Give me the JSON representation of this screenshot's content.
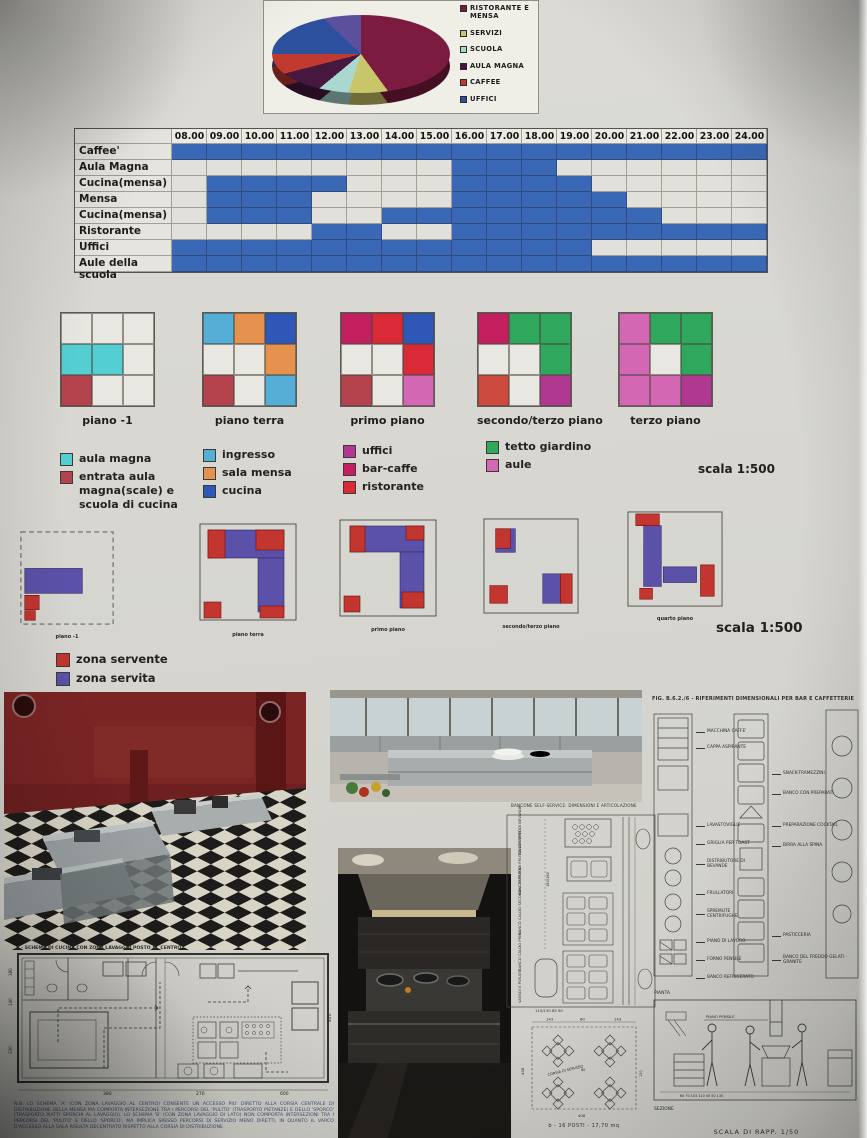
{
  "pie_panel": {
    "legend": [
      {
        "label": "RISTORANTE E MENSA",
        "color": "#7c1b40"
      },
      {
        "label": "SERVIZI",
        "color": "#c9c56a"
      },
      {
        "label": "SCUOLA",
        "color": "#a8d8cf"
      },
      {
        "label": "AULA MAGNA",
        "color": "#46173f"
      },
      {
        "label": "CAFFEE",
        "color": "#c03a30"
      },
      {
        "label": "UFFICI",
        "color": "#2c4f9e"
      }
    ],
    "slices": [
      {
        "label": "RISTORANTE E MENSA",
        "value": 40,
        "color": "#7c1b40"
      },
      {
        "label": "SERVIZI",
        "value": 15,
        "color": "#c9c56a"
      },
      {
        "label": "SCUOLA",
        "value": 9,
        "color": "#a8d8cf"
      },
      {
        "label": "AULA MAGNA",
        "value": 7,
        "color": "#46173f"
      },
      {
        "label": "CAFFEE",
        "value": 4,
        "color": "#c03a30"
      },
      {
        "label": "UFFICI",
        "value": 12,
        "color": "#2c4f9e"
      },
      {
        "label": null,
        "value": 13,
        "color": "#5b4f9e"
      }
    ]
  },
  "schedule": {
    "hours": [
      "08.00",
      "09.00",
      "10.00",
      "11.00",
      "12.00",
      "13.00",
      "14.00",
      "15.00",
      "16.00",
      "17.00",
      "18.00",
      "19.00",
      "20.00",
      "21.00",
      "22.00",
      "23.00",
      "24.00"
    ],
    "bar_color": "#3a68b4",
    "rows": [
      {
        "label": "Caffee'",
        "bars": [
          [
            8,
            25
          ]
        ]
      },
      {
        "label": "Aula Magna",
        "bars": [
          [
            16,
            19
          ]
        ]
      },
      {
        "label": "Cucina(mensa)",
        "bars": [
          [
            9,
            13
          ],
          [
            16,
            20
          ]
        ]
      },
      {
        "label": "Mensa",
        "bars": [
          [
            9,
            12
          ],
          [
            16,
            21
          ]
        ]
      },
      {
        "label": "Cucina(mensa)",
        "bars": [
          [
            9,
            12
          ],
          [
            14,
            22
          ]
        ]
      },
      {
        "label": "Ristorante",
        "bars": [
          [
            12,
            14
          ],
          [
            16,
            25
          ]
        ]
      },
      {
        "label": "Uffici",
        "bars": [
          [
            8,
            20
          ]
        ]
      },
      {
        "label": "Aule della scuola",
        "bars": [
          [
            8,
            25
          ]
        ]
      }
    ]
  },
  "floor_grids": {
    "grids": [
      {
        "label": "piano -1",
        "cells": [
          "",
          "",
          "",
          "#53cfd2",
          "#53cfd2",
          "",
          "#b5434e",
          "",
          ""
        ]
      },
      {
        "label": "piano terra",
        "cells": [
          "#54aed6",
          "#e5924f",
          "#2e57b8",
          "",
          "",
          "#e5924f",
          "#b5434e",
          "",
          "#54aed6"
        ]
      },
      {
        "label": "primo piano",
        "cells": [
          "#c41f5e",
          "#da2a38",
          "#2e57b8",
          "",
          "",
          "#da2a38",
          "#b5434e",
          "",
          "#d467b4"
        ]
      },
      {
        "label": "secondo/terzo piano",
        "cells": [
          "#c41f5e",
          "#2fa85e",
          "#2fa85e",
          "",
          "",
          "#2fa85e",
          "#cd4a3e",
          "",
          "#b03890"
        ]
      },
      {
        "label": "terzo piano",
        "cells": [
          "#d467b4",
          "#2fa85e",
          "#2fa85e",
          "#d467b4",
          "",
          "#2fa85e",
          "#d467b4",
          "#d467b4",
          "#b03890"
        ]
      }
    ]
  },
  "scale_small": "scala  1:500",
  "scale_large": "scala  1:500",
  "legend_groups": [
    {
      "items": [
        {
          "label": "aula magna",
          "color": "#53cfd2"
        },
        {
          "label": "entrata aula magna(scale) e scuola di cucina",
          "color": "#b5434e"
        }
      ]
    },
    {
      "items": [
        {
          "label": "ingresso",
          "color": "#54aed6"
        },
        {
          "label": "sala mensa",
          "color": "#e5924f"
        },
        {
          "label": "cucina",
          "color": "#2e57b8"
        }
      ]
    },
    {
      "items": [
        {
          "label": "uffici",
          "color": "#b03890"
        },
        {
          "label": "bar-caffe",
          "color": "#c41f5e"
        },
        {
          "label": "ristorante",
          "color": "#da2a38"
        }
      ]
    },
    {
      "items": [
        {
          "label": "tetto giardino",
          "color": "#2fa85e"
        },
        {
          "label": "aule",
          "color": "#d467b4"
        }
      ]
    }
  ],
  "plans": {
    "servente_color": "#c3352f",
    "servita_color": "#5b51a8",
    "items": [
      {
        "label": "piano -1",
        "outline": "dashed",
        "servita": [
          [
            6,
            40,
            60,
            26
          ]
        ],
        "servente": [
          [
            6,
            68,
            15,
            15
          ],
          [
            6,
            84,
            11,
            10
          ]
        ]
      },
      {
        "label": "piano terra",
        "outline": "solid",
        "servita": [
          [
            10,
            8,
            76,
            28
          ],
          [
            60,
            36,
            26,
            54
          ]
        ],
        "servente": [
          [
            10,
            8,
            17,
            28
          ],
          [
            58,
            8,
            28,
            20
          ],
          [
            6,
            80,
            17,
            16
          ],
          [
            62,
            84,
            24,
            12
          ]
        ]
      },
      {
        "label": "primo piano",
        "outline": "solid",
        "servita": [
          [
            12,
            8,
            74,
            26
          ],
          [
            62,
            34,
            24,
            56
          ]
        ],
        "servente": [
          [
            12,
            8,
            15,
            26
          ],
          [
            68,
            8,
            18,
            14
          ],
          [
            64,
            74,
            22,
            16
          ],
          [
            6,
            78,
            16,
            16
          ]
        ]
      },
      {
        "label": "secondo/terzo piano",
        "outline": "solid",
        "servita": [
          [
            14,
            12,
            20,
            24
          ],
          [
            62,
            58,
            18,
            30
          ]
        ],
        "servente": [
          [
            14,
            12,
            15,
            20
          ],
          [
            80,
            58,
            12,
            30
          ],
          [
            8,
            70,
            18,
            18
          ]
        ]
      },
      {
        "label": "quarto piano",
        "outline": "solid",
        "servita": [
          [
            18,
            16,
            18,
            62
          ],
          [
            38,
            58,
            34,
            16
          ]
        ],
        "servente": [
          [
            10,
            4,
            24,
            12
          ],
          [
            76,
            56,
            14,
            32
          ],
          [
            14,
            80,
            13,
            11
          ]
        ]
      }
    ]
  },
  "zone_legend": [
    {
      "label": "zona servente",
      "color": "#c3352f"
    },
    {
      "label": "zona servita",
      "color": "#5b51a8"
    }
  ],
  "tech_left": {
    "title": "A - SCHEMA DI CUCINA CON ZONA LAVAGGIO POSTO AL CENTRO",
    "dims_bottom": [
      "380",
      "270",
      "600"
    ],
    "dim_right": "820",
    "dims_left": [
      "180",
      "140",
      "330"
    ],
    "note": "N.B. LO SCHEMA 'A' (CON ZONA LAVAGGIO AL CENTRO) CONSENTE UN ACCESSO PIU' DIRETTO ALLA CORSIA CENTRALE DI DISTRIBUZIONE DELLA MENSA MA COMPORTA INTERSEZIONE TRA I PERCORSI DEL 'PULITO' (TRASPORTO PIETANZE) E DELLO 'SPORCO' (TRASPORTO PIATTI SPORCHI AL LAVAGGIO). LO SCHEMA 'B' (CON ZONA LAVAGGIO DI LATO) NON COMPORTA INTERSEZIONI TRA I PERCORSI DEL 'PULITO' E DELLO 'SPORCO', MA IMPLICA SPESSO PERCORSI DI SERVIZIO MENO DIRETTI, IN QUANTO IL VARCO D'ACCESSO ALLA SALA RISULTA DECENTRATO RISPETTO ALLA CORSIA DI DISTRIBUZIONE"
  },
  "tech_center": {
    "title": "BANCONE SELF-SERVICE: DIMENSIONI E ARTICOLAZIONE",
    "side_labels": [
      "BANCHI FREDDI BEVANDE",
      "BANCHI FREDDI FRUTTA-DESSERT",
      "BANCO CALDO SECONDI-CONTORNI",
      "BANCO CALDO PRIMI",
      "VASSOI E POSATE"
    ],
    "bottom_dims": "110/130      85      50",
    "height_dims": "150/180",
    "corsia_label": "CORSIA DI SERVIZIO",
    "table_dims": [
      "143",
      "60",
      "143",
      "438",
      "408",
      "80",
      "120"
    ],
    "tables_caption": "b - 16 POSTI - 17,70 mq"
  },
  "tech_right": {
    "title": "FIG. B.6.2./6 - RIFERIMENTI DIMENSIONALI PER BAR E CAFFETTERIE",
    "left_labels": [
      "MACCHINA CAFFE'",
      "CAPPA ASPIRANTE",
      "LAVASTOVIGLIE",
      "GRIGLIA PER TOAST",
      "DISTRIBUTORE DI BEVANDE",
      "FRULLATORI",
      "SPREMUTE CENTRIFUGHE",
      "PIANO DI LAVORO",
      "FORNO PENSILE",
      "BANCO REFRIGERATO"
    ],
    "right_labels": [
      "SNACK-TRAMEZZINI",
      "BANCO CON PREPARATI",
      "PREPARAZIONE COCKTAIL",
      "BIRRA ALLA SPINA",
      "PASTICCERIA",
      "BANCO DEL FREDDO GELATI - GRANITE"
    ],
    "pianta_label": "PIANTA",
    "sezione_label": "SEZIONE",
    "piano_pensile_label": "PIANO PENSILE",
    "scale_caption": "SCALA DI RAPP. 1/50"
  },
  "chart_data": [
    {
      "type": "pie",
      "labels": [
        "RISTORANTE E MENSA",
        "SERVIZI",
        "SCUOLA",
        "AULA MAGNA",
        "CAFFEE",
        "UFFICI"
      ],
      "values": [
        40,
        15,
        9,
        7,
        4,
        12
      ],
      "colors": [
        "#7c1b40",
        "#c9c56a",
        "#a8d8cf",
        "#46173f",
        "#c03a30",
        "#2c4f9e"
      ],
      "unlabeled_slice": {
        "value": 13,
        "color": "#5b4f9e"
      },
      "legend_position": "right"
    },
    {
      "type": "table",
      "x_categories": [
        "08.00",
        "09.00",
        "10.00",
        "11.00",
        "12.00",
        "13.00",
        "14.00",
        "15.00",
        "16.00",
        "17.00",
        "18.00",
        "19.00",
        "20.00",
        "21.00",
        "22.00",
        "23.00",
        "24.00"
      ],
      "bar_color": "#3a68b4",
      "rows": [
        {
          "label": "Caffee'",
          "intervals": [
            [
              8,
              25
            ]
          ]
        },
        {
          "label": "Aula Magna",
          "intervals": [
            [
              16,
              19
            ]
          ]
        },
        {
          "label": "Cucina(mensa)",
          "intervals": [
            [
              9,
              13
            ],
            [
              16,
              20
            ]
          ]
        },
        {
          "label": "Mensa",
          "intervals": [
            [
              9,
              12
            ],
            [
              16,
              21
            ]
          ]
        },
        {
          "label": "Cucina(mensa)",
          "intervals": [
            [
              9,
              12
            ],
            [
              14,
              22
            ]
          ]
        },
        {
          "label": "Ristorante",
          "intervals": [
            [
              12,
              14
            ],
            [
              16,
              25
            ]
          ]
        },
        {
          "label": "Uffici",
          "intervals": [
            [
              8,
              20
            ]
          ]
        },
        {
          "label": "Aule della scuola",
          "intervals": [
            [
              8,
              25
            ]
          ]
        }
      ]
    }
  ]
}
